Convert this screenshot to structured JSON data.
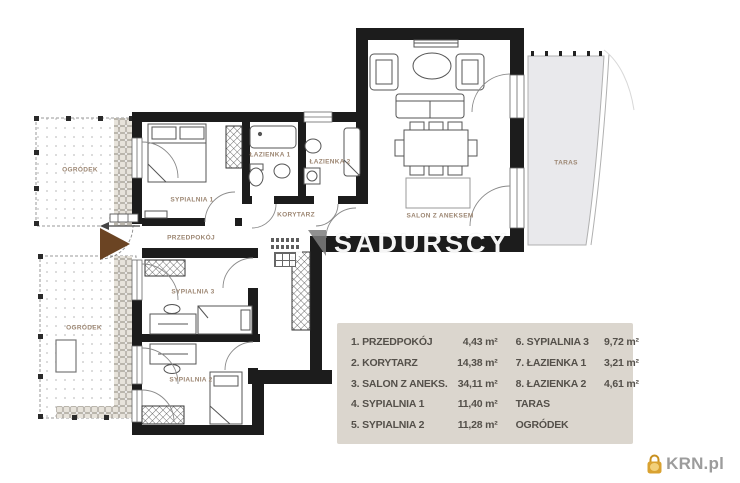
{
  "plan": {
    "labels": {
      "ogrodek_top": "OGRÓDEK",
      "ogrodek_bottom": "OGRÓDEK",
      "sypialnia1": "SYPIALNIA 1",
      "przedpokoj": "PRZEDPOKÓJ",
      "korytarz": "KORYTARZ",
      "lazienka1": "ŁAZIENKA 1",
      "lazienka2": "ŁAZIENKA 2",
      "salon": "SALON Z ANEKSEM",
      "sypialnia3": "SYPIALNIA 3",
      "sypialnia2": "SYPIALNIA 2",
      "taras": "TARAS"
    },
    "colors": {
      "wall": "#1c1c1c",
      "terrace_fill": "#e9e9ec",
      "legend_bg": "#dbd6ce",
      "label_text": "#9c8672",
      "entrance_door": "#6b4423",
      "brand_gold": "#d9a231"
    }
  },
  "legend": {
    "col1": [
      {
        "label": "1. PRZEDPOKÓJ",
        "area": "4,43 m²"
      },
      {
        "label": "2. KORYTARZ",
        "area": "14,38 m²"
      },
      {
        "label": "3. SALON Z ANEKS.",
        "area": "34,11 m²"
      },
      {
        "label": "4. SYPIALNIA 1",
        "area": "11,40 m²"
      },
      {
        "label": "5. SYPIALNIA 2",
        "area": "11,28 m²"
      }
    ],
    "col2": [
      {
        "label": "6. SYPIALNIA 3",
        "area": "9,72 m²"
      },
      {
        "label": "7. ŁAZIENKA 1",
        "area": "3,21 m²"
      },
      {
        "label": "8. ŁAZIENKA 2",
        "area": "4,61 m²"
      },
      {
        "label": "TARAS",
        "area": ""
      },
      {
        "label": "OGRÓDEK",
        "area": ""
      }
    ]
  },
  "watermark": {
    "text": "SADURSCY"
  },
  "brand": {
    "name": "KRN.pl"
  }
}
